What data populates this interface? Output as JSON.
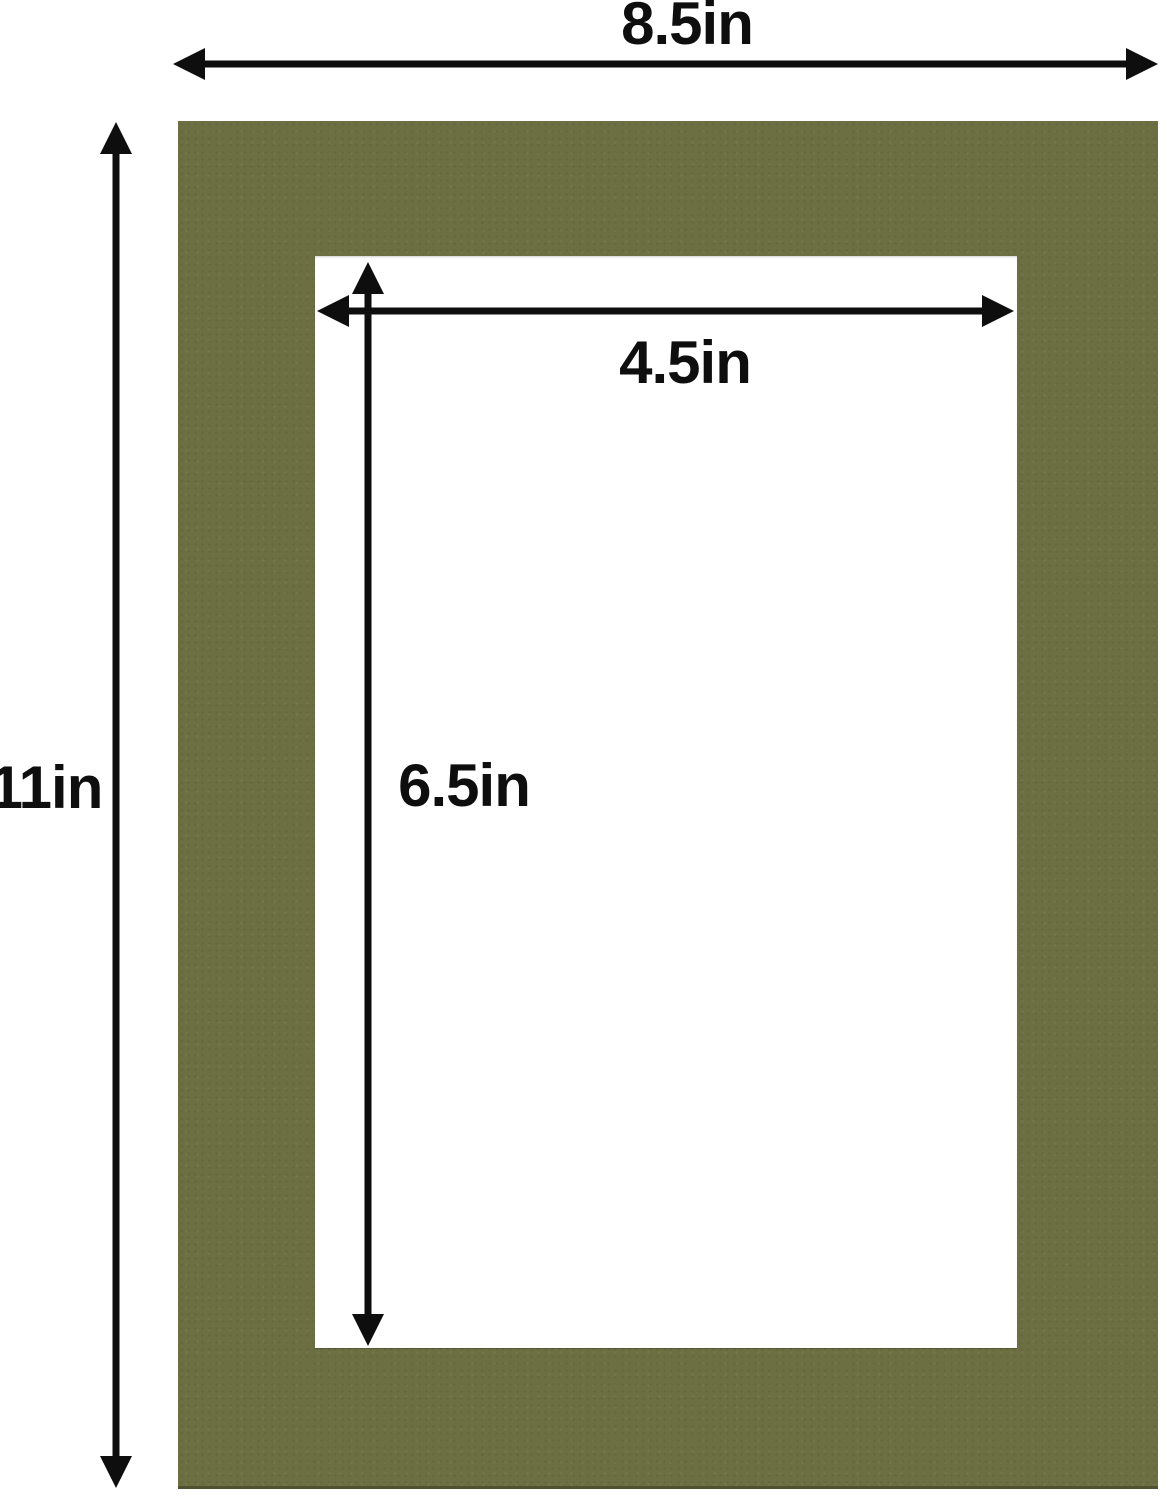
{
  "diagram": {
    "subject": "picture-frame-mat-with-dimension-arrows",
    "dimensions": {
      "outer_width": "8.5in",
      "outer_height": "11in",
      "opening_width": "4.5in",
      "opening_height": "6.5in"
    }
  },
  "colors": {
    "background": "#ffffff",
    "mat": "#6b6f42",
    "opening": "#ffffff",
    "annotation": "#0e0e0e"
  }
}
